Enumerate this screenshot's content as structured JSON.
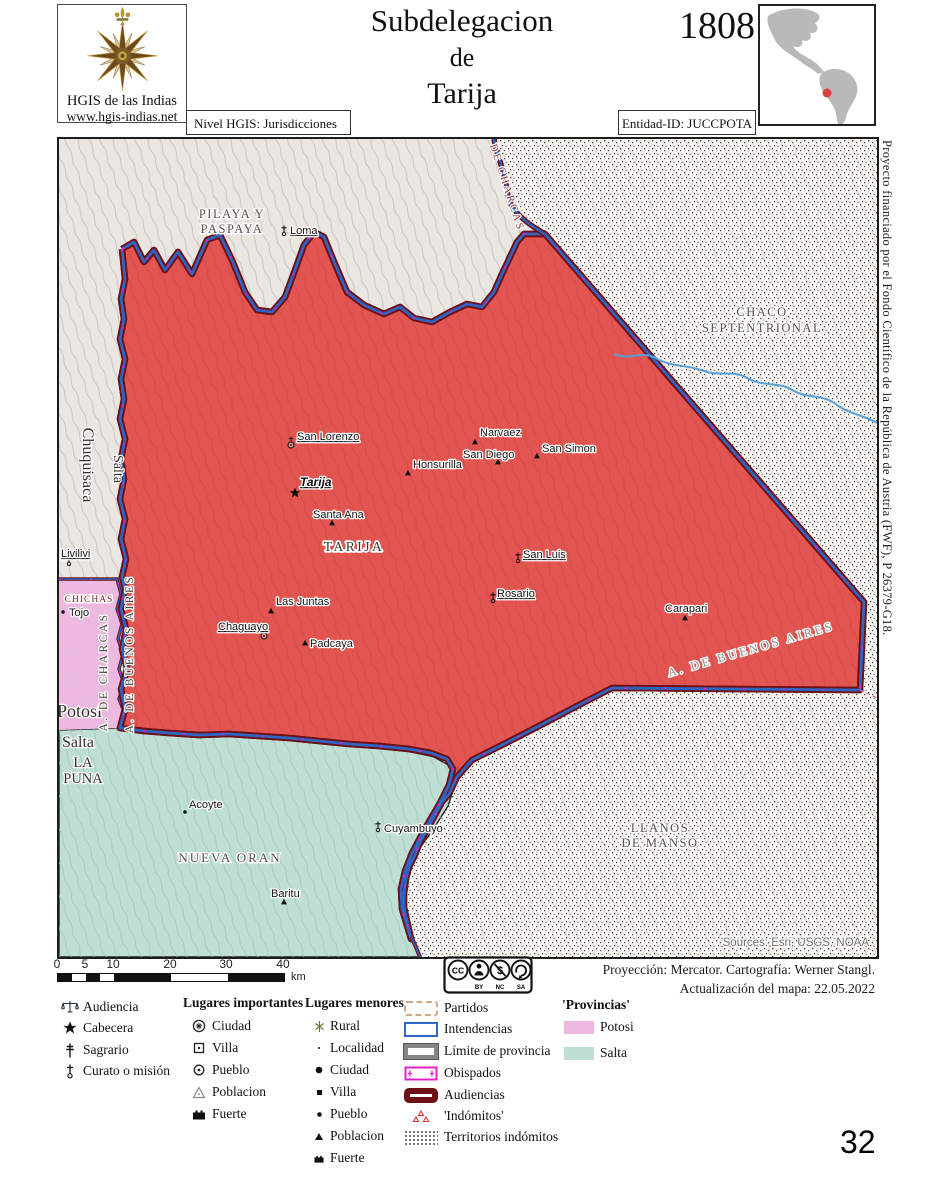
{
  "header": {
    "logo_title": "HGIS de las Indias",
    "logo_url": "www.hgis-indias.net",
    "level_label": "Nivel HGIS: Jurisdicciones",
    "title_line1": "Subdelegacion",
    "title_line2": "de",
    "title_line3": "Tarija",
    "year": "1808",
    "entity_id": "Entidad-ID: JUCCPOTA"
  },
  "map": {
    "regions": {
      "pilaya_l1": "PILAYA Y",
      "pilaya_l2": "PASPAYA",
      "chaco_l1": "CHACO",
      "chaco_l2": "SEPTENTRIONAL",
      "llanos_l1": "LLANOS",
      "llanos_l2": "DE MANSO",
      "nueva_oran": "NUEVA ORAN",
      "tarija_region": "TARIJA",
      "la_puna_l1": "LA",
      "la_puna_l2": "PUNA",
      "chichas": "CHICHAS",
      "potosi": "Potosi",
      "salta_bottom": "Salta",
      "chuquisaca": "Chuquisaca",
      "salta_strip": "Salta"
    },
    "borders": {
      "charcas_top": "A. DE CHARCAS",
      "charcas_west": "A. DE CHARCAS",
      "buenos_aires_west": "A. DE BUENOS AIRES",
      "buenos_aires_se": "A. DE BUENOS AIRES"
    },
    "places": {
      "loma": "Loma",
      "livilivi": "Livilivi",
      "san_lorenzo": "San Lorenzo",
      "tarija": "Tarija",
      "honsurilla": "Honsurilla",
      "narvaez": "Narvaez",
      "san_diego": "San Diego",
      "san_simon": "San Simon",
      "santa_ana": "Santa Ana",
      "san_luis": "San Luis",
      "rosario": "Rosario",
      "las_juntas": "Las Juntas",
      "chaguayo": "Chaguayo",
      "padcaya": "Padcaya",
      "carapari": "Carapari",
      "tojo": "Tojo",
      "acoyte": "Acoyte",
      "baritu": "Baritu",
      "cuyambuyo": "Cuyambuyo"
    },
    "sources": "Sources: Esri, USGS, NOAA"
  },
  "margin_note": "Proyecto financiado por el Fondo Científico de la República de Austria (FWF),  P 26379-G18.",
  "scalebar": {
    "ticks": [
      "0",
      "5",
      "10",
      "20",
      "30",
      "40"
    ],
    "unit": "km"
  },
  "license": {
    "cc": "CC",
    "by": "BY",
    "nc": "NC",
    "sa": "SA"
  },
  "attribution": {
    "line1": "Proyección: Mercator. Cartografía: Werner Stangl.",
    "line2": "Actualización del mapa: 22.05.2022"
  },
  "legend": {
    "col1": [
      "Audiencia",
      "Cabecera",
      "Sagrario",
      "Curato o misión"
    ],
    "col2_header": "Lugares importantes",
    "col2": [
      "Ciudad",
      "Villa",
      "Pueblo",
      "Poblacion",
      "Fuerte"
    ],
    "col3_header": "Lugares menores",
    "col3": [
      "Rural",
      "Localidad",
      "Ciudad",
      "Villa",
      "Pueblo",
      "Poblacion",
      "Fuerte"
    ],
    "col4": [
      "Partidos",
      "Intendencias",
      "Límite de provincia",
      "Obispados",
      "Audiencias",
      "'Indómitos'",
      "Territorios indómitos"
    ],
    "col5_header": "'Provincias'",
    "col5": [
      {
        "label": "Potosi",
        "color": "#edb9e1"
      },
      {
        "label": "Salta",
        "color": "#bfdfd4"
      }
    ]
  },
  "page_number": "32",
  "colors": {
    "tarija_fill": "#e25551",
    "audiencia_border": "#6e1016",
    "intendencia_border": "#2f66c4",
    "obispado_line": "#e620c6",
    "river": "#56a0dc"
  }
}
